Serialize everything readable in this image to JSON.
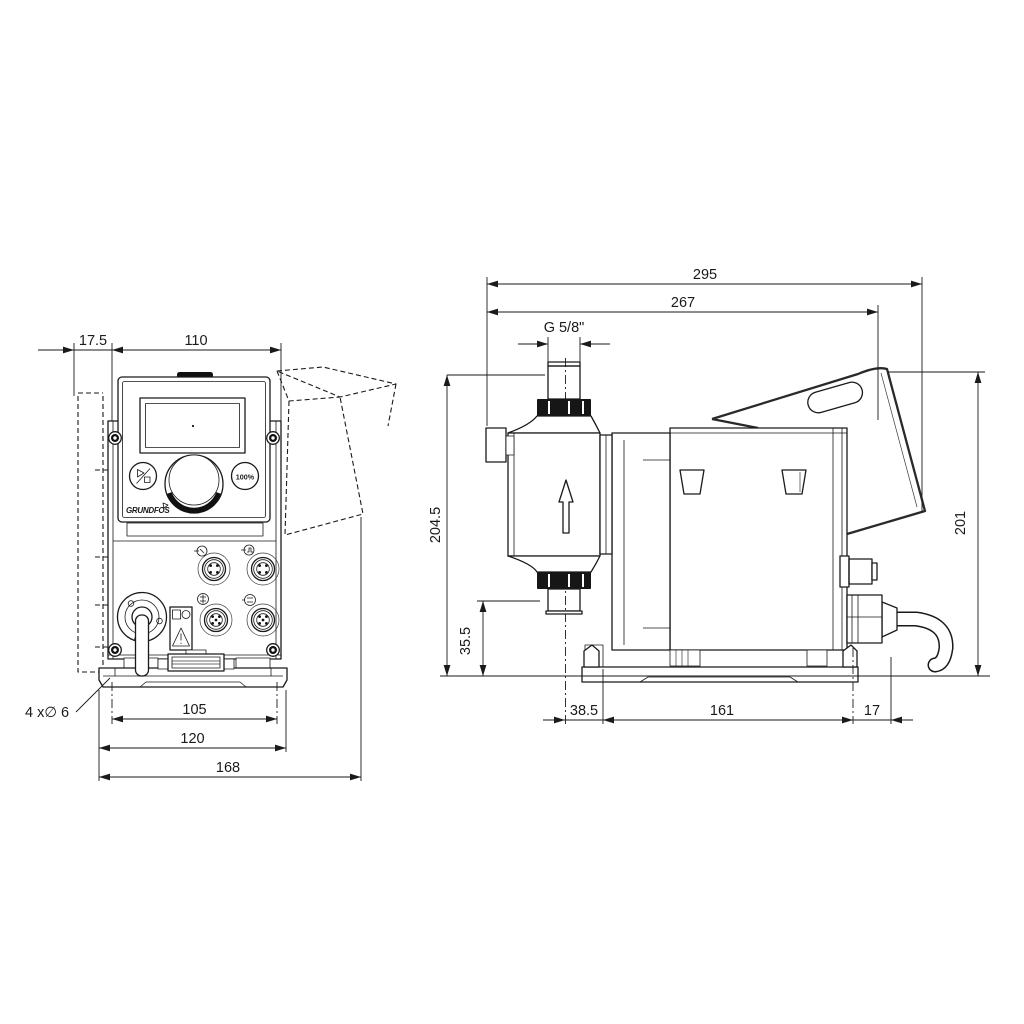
{
  "front": {
    "d17_5": "17.5",
    "d110": "110",
    "d105": "105",
    "d120": "120",
    "d168": "168",
    "holes": "4 x∅ 6",
    "btn_100": "100%",
    "brand": "GRUNDFOS"
  },
  "side": {
    "d295": "295",
    "d267": "267",
    "thread": "G 5/8\"",
    "d204_5": "204.5",
    "d35_5": "35.5",
    "d38_5": "38.5",
    "d161": "161",
    "d17": "17",
    "d201": "201"
  },
  "colors": {
    "line": "#1a1a1a",
    "background": "#ffffff"
  }
}
